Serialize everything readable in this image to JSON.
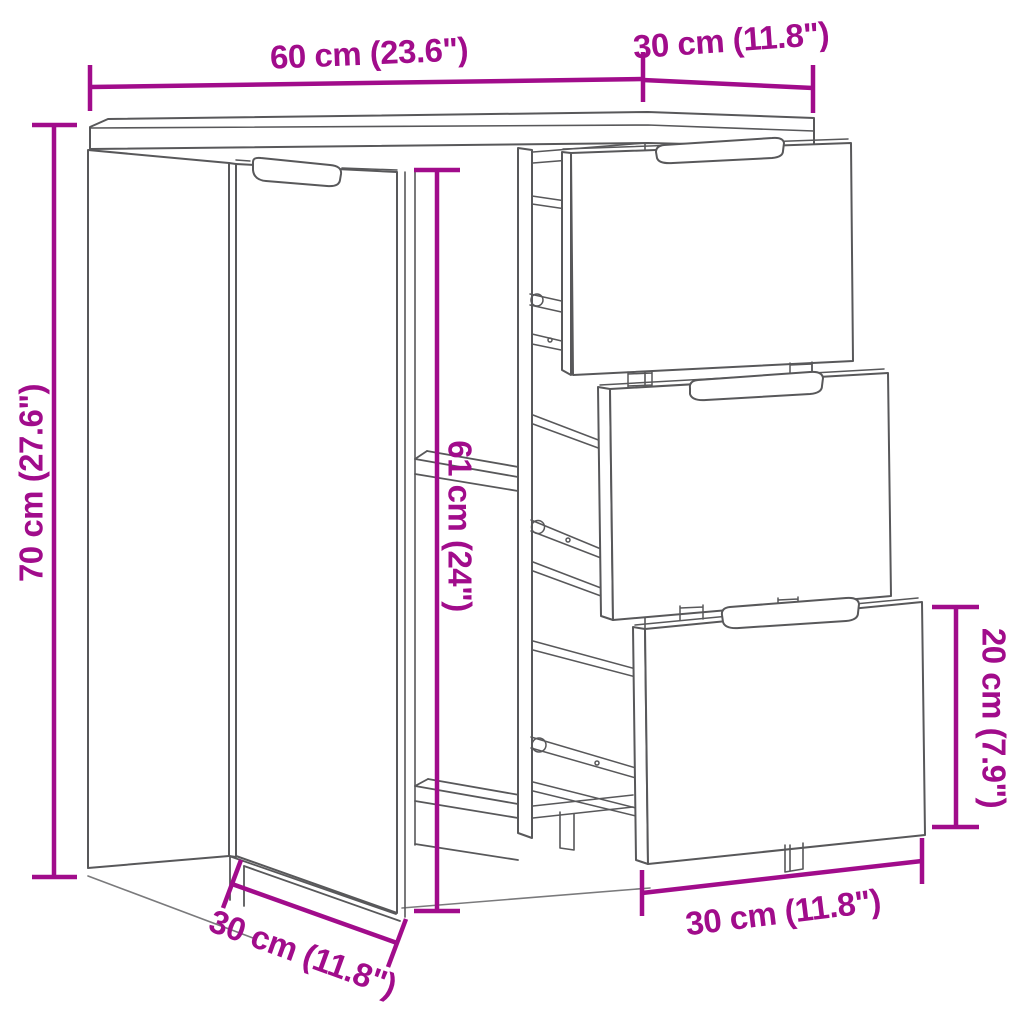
{
  "title": "Sideboard dimension diagram",
  "colors": {
    "dimension_accent": "#A10C8B",
    "line_art": "#58585a"
  },
  "dimensions": {
    "width": {
      "label": "60 cm (23.6\")"
    },
    "depth_top": {
      "label": "30 cm (11.8\")"
    },
    "height": {
      "label": "70 cm (27.6\")"
    },
    "interior_height": {
      "label": "61 cm (24\")"
    },
    "drawer_height": {
      "label": "20 cm (7.9\")"
    },
    "drawer_width": {
      "label": "30 cm (11.8\")"
    },
    "depth_bottom": {
      "label": "30 cm (11.8\")"
    }
  }
}
